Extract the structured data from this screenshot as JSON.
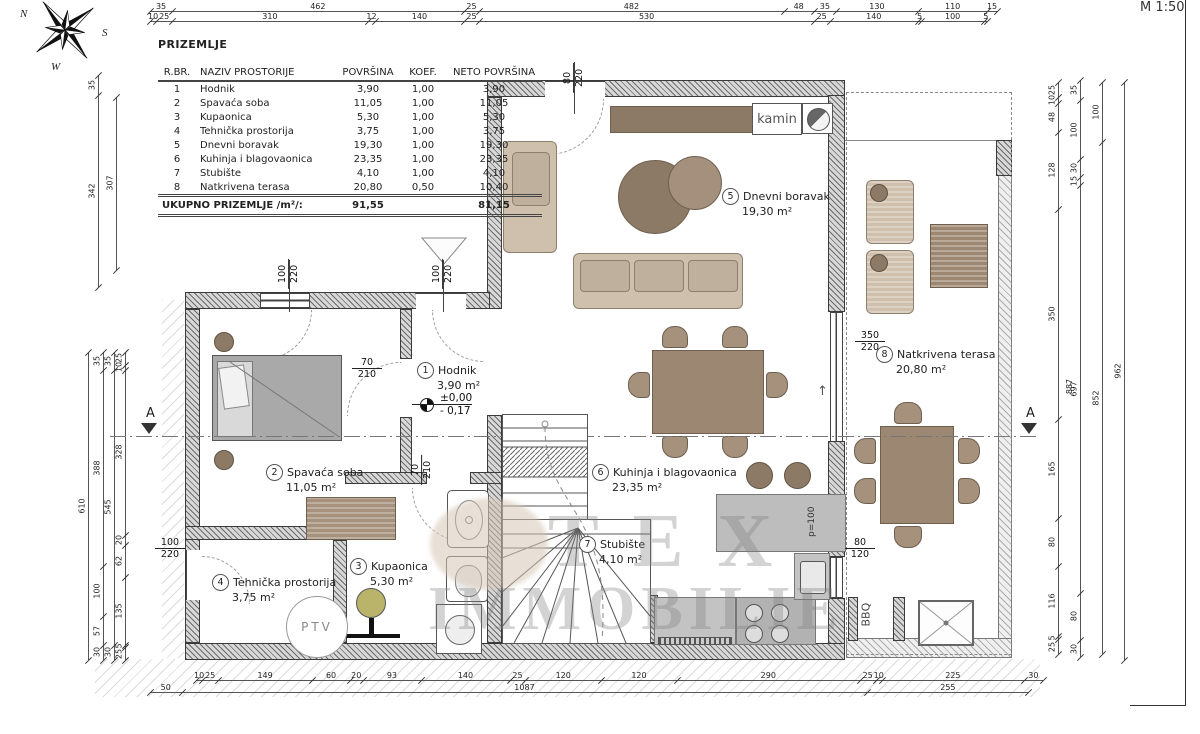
{
  "meta": {
    "scale_label": "M 1:50",
    "compass": {
      "n": "N",
      "s": "S",
      "w": "W"
    }
  },
  "table": {
    "title": "PRIZEMLJE",
    "headers": [
      "R.BR.",
      "NAZIV PROSTORIJE",
      "POVRŠINA",
      "KOEF.",
      "NETO POVRŠINA"
    ],
    "rows": [
      [
        "1",
        "Hodnik",
        "3,90",
        "1,00",
        "3,90"
      ],
      [
        "2",
        "Spavaća soba",
        "11,05",
        "1,00",
        "11,05"
      ],
      [
        "3",
        "Kupaonica",
        "5,30",
        "1,00",
        "5,30"
      ],
      [
        "4",
        "Tehnička prostorija",
        "3,75",
        "1,00",
        "3,75"
      ],
      [
        "5",
        "Dnevni boravak",
        "19,30",
        "1,00",
        "19,30"
      ],
      [
        "6",
        "Kuhinja i blagovaonica",
        "23,35",
        "1,00",
        "23,35"
      ],
      [
        "7",
        "Stubište",
        "4,10",
        "1,00",
        "4,10"
      ],
      [
        "8",
        "Natkrivena terasa",
        "20,80",
        "0,50",
        "10,40"
      ]
    ],
    "total_label": "UKUPNO PRIZEMLJE /m²/:",
    "total_povrsina": "91,55",
    "total_neto": "81,15"
  },
  "rooms": [
    {
      "num": "1",
      "name": "Hodnik",
      "area": "3,90 m²"
    },
    {
      "num": "2",
      "name": "Spavaća soba",
      "area": "11,05 m²"
    },
    {
      "num": "3",
      "name": "Kupaonica",
      "area": "5,30 m²"
    },
    {
      "num": "4",
      "name": "Tehnička prostorija",
      "area": "3,75 m²"
    },
    {
      "num": "5",
      "name": "Dnevni boravak",
      "area": "19,30 m²"
    },
    {
      "num": "6",
      "name": "Kuhinja i blagovaonica",
      "area": "23,35 m²"
    },
    {
      "num": "7",
      "name": "Stubište",
      "area": "4,10 m²"
    },
    {
      "num": "8",
      "name": "Natkrivena terasa",
      "area": "20,80 m²"
    }
  ],
  "openings": [
    {
      "id": "win-bedroom",
      "top": "100",
      "bottom": "220"
    },
    {
      "id": "win-hall",
      "top": "100",
      "bottom": "220"
    },
    {
      "id": "door-living-top",
      "top": "80",
      "bottom": "220"
    },
    {
      "id": "door-bedroom",
      "top": "70",
      "bottom": "210"
    },
    {
      "id": "door-bathroom",
      "top": "70",
      "bottom": "210"
    },
    {
      "id": "door-terrace",
      "top": "350",
      "bottom": "220"
    },
    {
      "id": "win-kitchen",
      "top": "80",
      "bottom": "120"
    },
    {
      "id": "door-tech",
      "top": "100",
      "bottom": "220"
    }
  ],
  "labels": {
    "kamin": "kamin",
    "ptv": "PTV",
    "bbq": "BBQ",
    "p100": "p=100",
    "level_top": "±0,00",
    "level_bottom": "- 0,17",
    "section_a": "A",
    "up_arrow": "↑"
  },
  "watermark": {
    "line1": "TEX",
    "line2": "IMMOBILIE"
  },
  "dims": {
    "top1": [
      "35",
      "462",
      "25",
      "482",
      "48",
      "35",
      "130",
      "110",
      "15"
    ],
    "top2": [
      "10",
      "25",
      "310",
      "12",
      "140",
      "25",
      "530",
      "25",
      "140",
      "5",
      "100",
      "5"
    ],
    "bottom1": [
      "10",
      "25",
      "149",
      "60",
      "20",
      "93",
      "140",
      "25",
      "120",
      "120",
      "290",
      "25",
      "10",
      "225",
      "30"
    ],
    "bottom2": [
      "50",
      "1087",
      "255"
    ],
    "left_top1": [
      "35",
      "342"
    ],
    "left_top2": [
      "307"
    ],
    "left_low_total": [
      "610"
    ],
    "left_low2": [
      "35",
      "388",
      "100",
      "57",
      "30"
    ],
    "left_low3": [
      "35",
      "545",
      "30"
    ],
    "left_low4": [
      "25",
      "10",
      "328",
      "20",
      "62",
      "135",
      "5",
      "25"
    ],
    "right1": [
      "25",
      "10",
      "48",
      "128",
      "350",
      "165",
      "80",
      "116",
      "5",
      "25"
    ],
    "right2": [
      "35",
      "100",
      "30",
      "15",
      "697",
      "80",
      "30"
    ],
    "right3": [
      "100",
      "852"
    ],
    "right4": [
      "962"
    ],
    "right_extra": "887"
  }
}
